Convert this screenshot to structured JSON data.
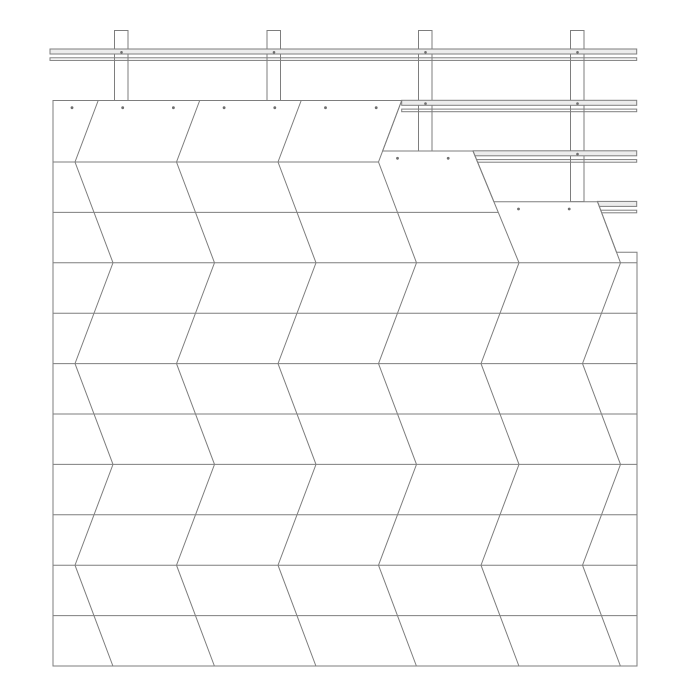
{
  "canvas": {
    "width": 700,
    "height": 700,
    "background": "#ffffff"
  },
  "drawing": {
    "kind": "cladding-installation-detail",
    "stroke_color": "#7e7e7e",
    "stroke_width": 1,
    "dot_color": "#6e6e6e",
    "rail_fill": "#ececec",
    "panel_fill": "#ffffff",
    "field": {
      "left": 53,
      "right": 637,
      "bottom": 666,
      "outline": [
        [
          53,
          666
        ],
        [
          53,
          100.5
        ],
        [
          401.7,
          100.5
        ],
        [
          382.6,
          151
        ],
        [
          473,
          151
        ],
        [
          493.9,
          201.7
        ],
        [
          597.5,
          201.7
        ],
        [
          616.5,
          252.2
        ],
        [
          637,
          252.2
        ],
        [
          637,
          666
        ]
      ],
      "courses": [
        {
          "top_y": 100.5,
          "x_start": 53,
          "x_end": 401.7
        },
        {
          "top_y": 151,
          "x_start": 382.6,
          "x_end": 473
        },
        {
          "top_y": 201.7,
          "x_start": 493.9,
          "x_end": 597.5
        },
        {
          "top_y": 252.2,
          "x_start": 616.5,
          "x_end": 637
        }
      ],
      "row_lines": [
        {
          "y": 162,
          "x1": 53,
          "x2": 378.5
        },
        {
          "y": 212.4,
          "x1": 53,
          "x2": 498.3
        },
        {
          "y": 262.8,
          "x1": 53,
          "x2": 637
        },
        {
          "y": 313.2,
          "x1": 53,
          "x2": 637
        },
        {
          "y": 363.6,
          "x1": 53,
          "x2": 637
        },
        {
          "y": 414,
          "x1": 53,
          "x2": 637
        },
        {
          "y": 464.4,
          "x1": 53,
          "x2": 637
        },
        {
          "y": 514.8,
          "x1": 53,
          "x2": 637
        },
        {
          "y": 565.2,
          "x1": 53,
          "x2": 637
        },
        {
          "y": 615.6,
          "x1": 53,
          "x2": 637
        }
      ],
      "zigzag_boundaries": [
        {
          "points": [
            [
              98.2,
              100.5
            ],
            [
              75,
              162
            ],
            [
              113,
              262.8
            ],
            [
              75,
              363.6
            ],
            [
              113,
              464.4
            ],
            [
              75,
              565.2
            ],
            [
              112.9,
              666
            ]
          ]
        },
        {
          "points": [
            [
              199.7,
              100.5
            ],
            [
              176.5,
              162
            ],
            [
              214.5,
              262.8
            ],
            [
              176.5,
              363.6
            ],
            [
              214.5,
              464.4
            ],
            [
              176.5,
              565.2
            ],
            [
              214.4,
              666
            ]
          ]
        },
        {
          "points": [
            [
              301.2,
              100.5
            ],
            [
              278,
              162
            ],
            [
              316,
              262.8
            ],
            [
              278,
              363.6
            ],
            [
              316,
              464.4
            ],
            [
              278,
              565.2
            ],
            [
              315.9,
              666
            ]
          ]
        },
        {
          "points": [
            [
              401.7,
              100.5
            ],
            [
              378.5,
              162
            ],
            [
              416.5,
              262.8
            ],
            [
              378.5,
              363.6
            ],
            [
              416.5,
              464.4
            ],
            [
              378.5,
              565.2
            ],
            [
              416.4,
              666
            ]
          ]
        },
        {
          "points": [
            [
              473,
              151
            ],
            [
              519,
              262.8
            ],
            [
              481,
              363.6
            ],
            [
              519,
              464.4
            ],
            [
              481,
              565.2
            ],
            [
              518.9,
              666
            ]
          ]
        },
        {
          "points": [
            [
              597.5,
              201.7
            ],
            [
              620.5,
              262.8
            ],
            [
              582.5,
              363.6
            ],
            [
              620.5,
              464.4
            ],
            [
              582.5,
              565.2
            ],
            [
              620.4,
              666
            ]
          ]
        }
      ],
      "fastener_dots": {
        "radius": 1.4,
        "groups": [
          {
            "y": 107.7,
            "xs": [
              72,
              122.7,
              173.4,
              224.1,
              274.8,
              325.5,
              376.2
            ]
          },
          {
            "y": 158.3,
            "xs": [
              397.5,
              448.2
            ]
          },
          {
            "y": 209,
            "xs": [
              518.5,
              569.2
            ]
          }
        ]
      }
    },
    "battens": {
      "posts": [
        {
          "x": 114.5,
          "width": 13.5,
          "top": 30.5,
          "bottom": 100.5
        },
        {
          "x": 267,
          "width": 13.5,
          "top": 30.5,
          "bottom": 100.5
        },
        {
          "x": 418.5,
          "width": 13.5,
          "top": 30.5,
          "bottom": 151
        },
        {
          "x": 570.5,
          "width": 13.5,
          "top": 30.5,
          "bottom": 201.7
        }
      ],
      "rails": [
        {
          "y": 49,
          "x1": 50,
          "x2": 636.7
        },
        {
          "y": 100.3,
          "x1": 401.7,
          "x2": 636.7
        },
        {
          "y": 150.8,
          "x1": 473,
          "x2": 636.7
        },
        {
          "y": 201.4,
          "x1": 597.4,
          "x2": 636.7
        }
      ],
      "rail_profile": {
        "upper_height": 5,
        "lower_offset": 8.8,
        "lower_height": 2.6
      },
      "screw_dots": {
        "radius": 1.3,
        "points": [
          [
            121.5,
            52.3
          ],
          [
            274,
            52.3
          ],
          [
            425.5,
            52.3
          ],
          [
            577.5,
            52.3
          ],
          [
            425.5,
            103.6
          ],
          [
            577.5,
            103.6
          ],
          [
            577.5,
            154.1
          ]
        ]
      }
    }
  }
}
